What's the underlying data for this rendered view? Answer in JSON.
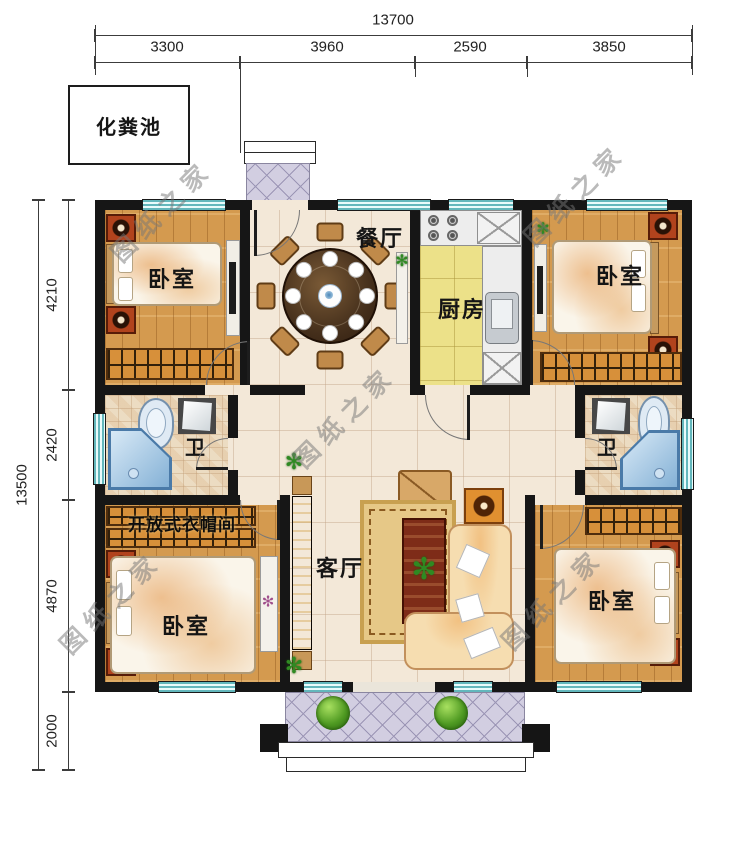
{
  "dimensions": {
    "top": {
      "total": "13700",
      "segments": [
        "3300",
        "3960",
        "2590",
        "3850"
      ]
    },
    "left": {
      "total": "13500",
      "segments": [
        "4210",
        "2420",
        "4870",
        "2000"
      ]
    }
  },
  "labels": {
    "septic_tank": "化粪池",
    "bedroom_tl": "卧室",
    "dining": "餐厅",
    "kitchen": "厨房",
    "bedroom_tr": "卧室",
    "bath_left": "卫",
    "bath_right": "卫",
    "cloakroom": "开放式衣帽间",
    "bedroom_bl": "卧室",
    "living": "客厅",
    "bedroom_br": "卧室"
  },
  "watermark": {
    "text": "图纸之家"
  },
  "colors": {
    "wall": "#161616",
    "window_teal": "#63b7bc",
    "wood_floor": "#d49a4f",
    "tile_floor": "#f3e8d8",
    "kitchen_floor": "#ece189",
    "porch_tile": "#d2cee1",
    "accent_red": "#b1431d",
    "wardrobe_orange": "#d7903a"
  }
}
